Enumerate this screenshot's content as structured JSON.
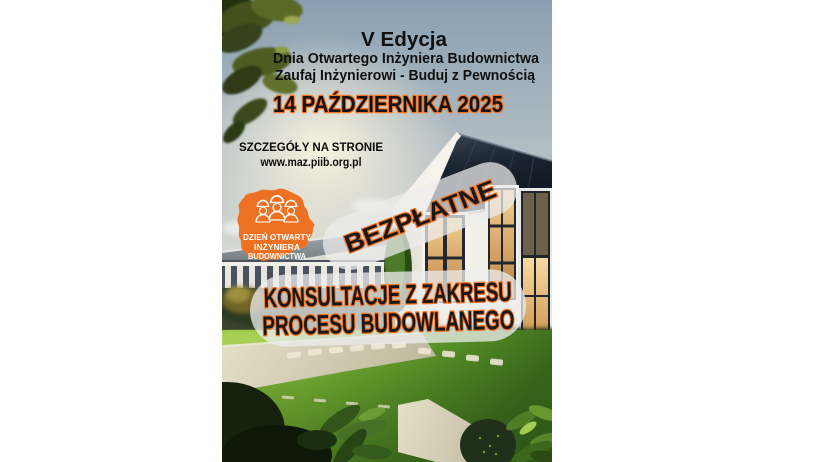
{
  "poster": {
    "header": {
      "edition": "V Edycja",
      "event_name": "Dnia Otwartego Inżyniera Budownictwa",
      "slogan": "Zaufaj Inżynierowi - Buduj z Pewnością",
      "date": "14 PAŹDZIERNIKA 2025"
    },
    "details": {
      "label": "SZCZEGÓŁY NA STRONIE",
      "url": "www.maz.piib.org.pl"
    },
    "logo": {
      "line1": "DZIEŃ OTWARTY",
      "line2": "INŻYNIERA",
      "line3": "BUDOWNICTWA"
    },
    "banners": {
      "free": "BEZPŁATNE",
      "consult_line1": "KONSULTACJE Z ZAKRESU",
      "consult_line2": "PROCESU BUDOWLANEGO"
    },
    "colors": {
      "accent_orange": "#ee7023",
      "outline_orange": "#f4711f",
      "text_black": "#141414",
      "banner_bg": "#ececec"
    }
  }
}
